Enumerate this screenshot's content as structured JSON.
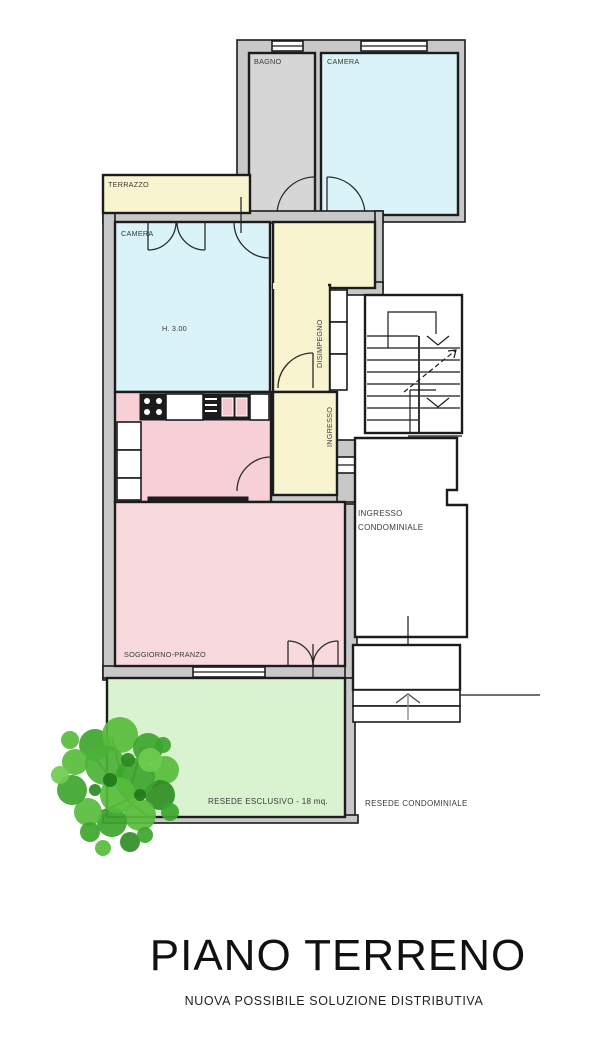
{
  "plan": {
    "rooms": {
      "terrazzo": {
        "label": "TERRAZZO"
      },
      "bagno": {
        "label": "BAGNO"
      },
      "camera_top": {
        "label": "CAMERA"
      },
      "camera": {
        "label": "CAMERA",
        "height_note": "H. 3.00"
      },
      "disimpegno": {
        "label": "DISIMPEGNO"
      },
      "ingresso": {
        "label": "INGRESSO"
      },
      "ingresso_condominiale": {
        "line1": "INGRESSO",
        "line2": "CONDOMINIALE"
      },
      "soggiorno": {
        "label": "SOGGIORNO-PRANZO"
      },
      "resede_esclusivo": {
        "label": "RESEDE ESCLUSIVO - 18 mq."
      },
      "resede_condominiale": {
        "label": "RESEDE CONDOMINIALE"
      }
    },
    "title": "PIANO TERRENO",
    "subtitle": "NUOVA POSSIBILE SOLUZIONE DISTRIBUTIVA",
    "colors": {
      "wall_fill": "#c8c8c8",
      "line": "#1c1c1c",
      "room_cyan": "#d9f3f8",
      "room_yellow": "#f9f4d0",
      "room_pink": "#f7d6db",
      "room_gray": "#d6d6d6",
      "garden_green": "#d9f2cf",
      "tree_green": "#3da52e"
    }
  }
}
